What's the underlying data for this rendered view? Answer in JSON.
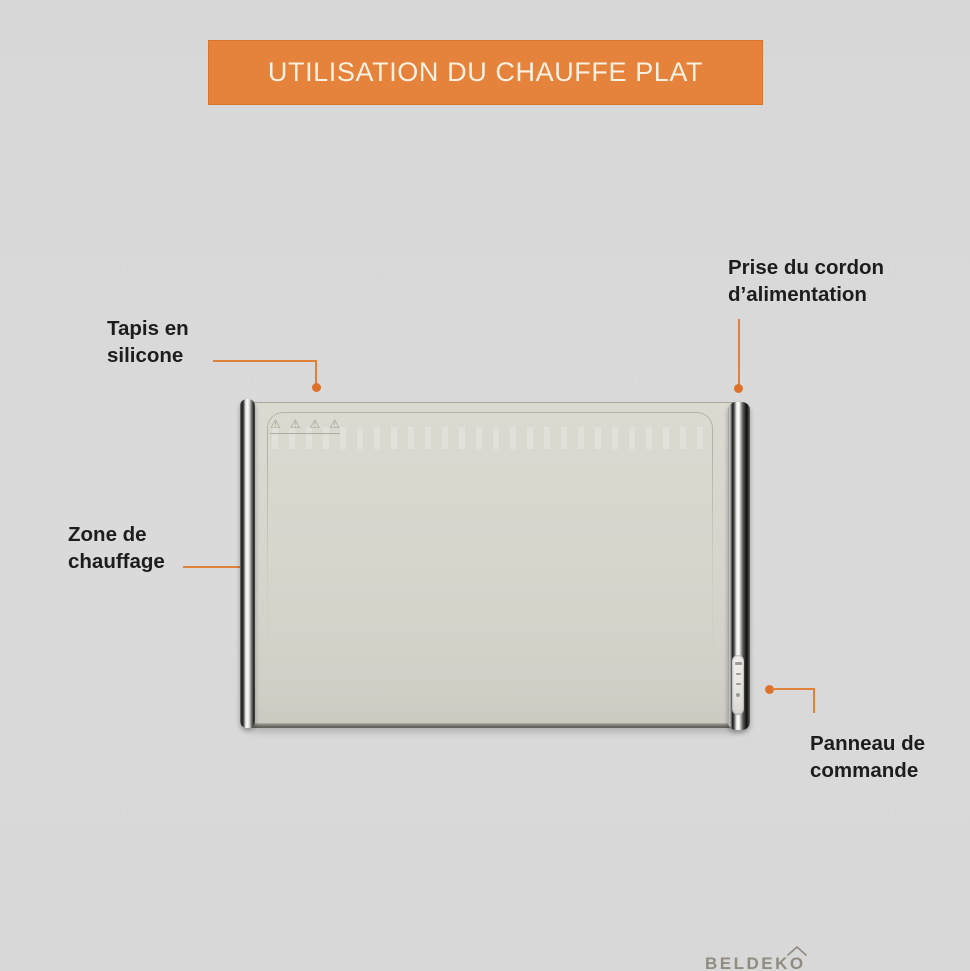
{
  "header": {
    "title": "UTILISATION DU CHAUFFE PLAT"
  },
  "product": {
    "brand": "BELDEKO",
    "brand_display": "BELDEK",
    "brand_last_letter": "O"
  },
  "annotations": {
    "silicone_mat": {
      "line1": "Tapis en",
      "line2": "silicone"
    },
    "power_cord": {
      "line1": "Prise du cordon",
      "line2": "d’alimentation"
    },
    "heating_zone": {
      "line1": "Zone de",
      "line2": "chauffage"
    },
    "control_panel": {
      "line1": "Panneau de",
      "line2": "commande"
    }
  },
  "icons": {
    "safety_glyph": "⚠"
  },
  "colors": {
    "accent_orange": "#E0813C",
    "dot_orange": "#DD712A",
    "banner_orange": "#E5823B",
    "banner_text": "#F8F1E2",
    "background_gray": "#D9D9D9",
    "device_body": "#D6D5CC",
    "label_text": "#1D1D1D",
    "logo_gray": "#908C81"
  }
}
